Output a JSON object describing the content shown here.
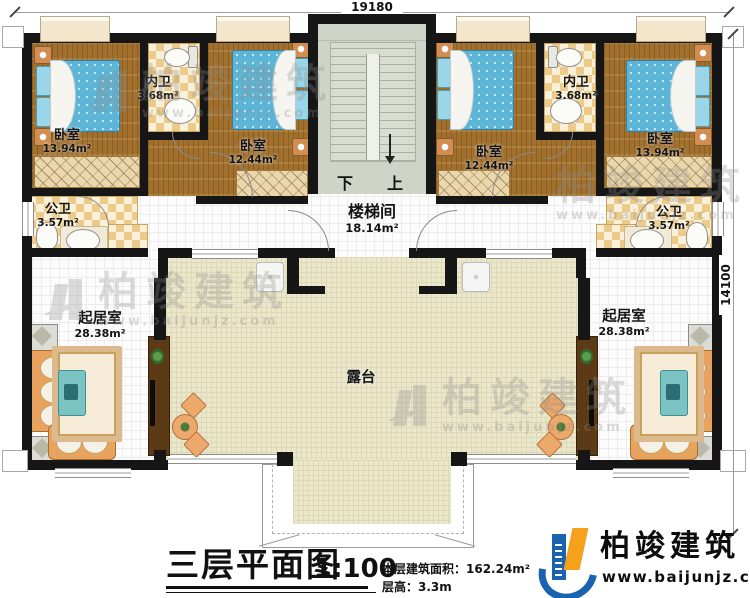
{
  "dimensions": {
    "top": "19180",
    "right": "14100"
  },
  "rooms": {
    "bedL1": {
      "name": "卧室",
      "area": "13.94m²"
    },
    "innerBathL": {
      "name": "内卫",
      "area": "3.68m²"
    },
    "bedL2": {
      "name": "卧室",
      "area": "12.44m²"
    },
    "pubBathL": {
      "name": "公卫",
      "area": "3.57m²"
    },
    "stair": {
      "name": "楼梯间",
      "area": "18.14m²"
    },
    "bedR2": {
      "name": "卧室",
      "area": "12.44m²"
    },
    "innerBathR": {
      "name": "内卫",
      "area": "3.68m²"
    },
    "bedR1": {
      "name": "卧室",
      "area": "13.94m²"
    },
    "pubBathR": {
      "name": "公卫",
      "area": "3.57m²"
    },
    "livingL": {
      "name": "起居室",
      "area": "28.38m²"
    },
    "livingR": {
      "name": "起居室",
      "area": "28.38m²"
    },
    "terrace": {
      "name": "露台"
    }
  },
  "stairs": {
    "down": "下",
    "up": "上"
  },
  "titleblock": {
    "title": "三层平面图",
    "scale": "1:100",
    "area_line": "本层建筑面积：162.24m²",
    "height_line": "层高：3.3m"
  },
  "brand": {
    "name": "柏竣建筑",
    "url": "www.baijunjz.com"
  },
  "watermark": {
    "name": "柏竣建筑",
    "url": "www.baijunjz.com"
  }
}
